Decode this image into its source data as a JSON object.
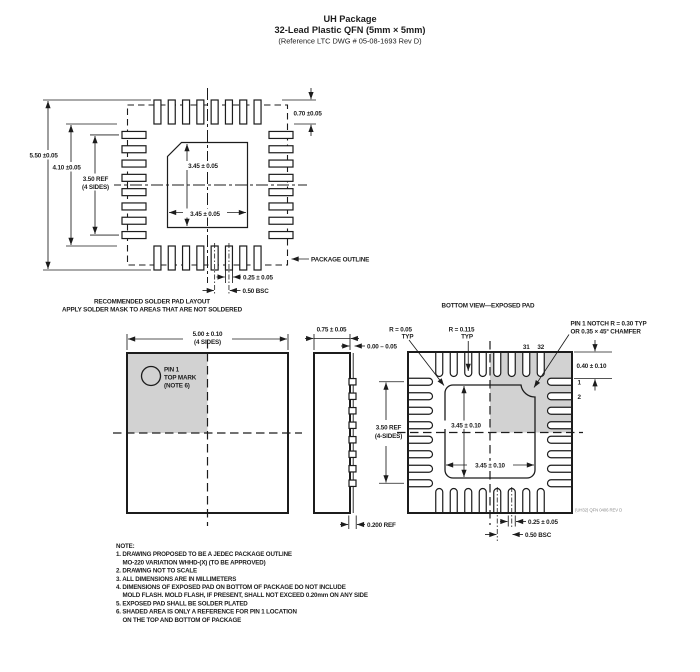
{
  "header": {
    "title": "UH Package",
    "subtitle": "32-Lead Plastic QFN (5mm × 5mm)",
    "reference": "(Reference LTC DWG # 05-08-1693 Rev D)"
  },
  "solder": {
    "caption1": "RECOMMENDED SOLDER PAD LAYOUT",
    "caption2": "APPLY SOLDER MASK TO AREAS THAT ARE NOT SOLDERED",
    "dim_overall": "5.50 ±0.05",
    "dim_inner": "4.10 ±0.05",
    "dim_span1": "3.50 REF",
    "dim_span2": "(4 SIDES)",
    "dim_pad_v": "3.45 ± 0.05",
    "dim_pad_h": "3.45 ± 0.05",
    "dim_pad_len": "0.70 ±0.05",
    "dim_pad_w": "0.25 ± 0.05",
    "dim_pitch": "0.50 BSC",
    "outline_label": "PACKAGE OUTLINE"
  },
  "top_view": {
    "dim1": "5.00 ± 0.10",
    "dim2": "(4 SIDES)",
    "pin1_l1": "PIN 1",
    "pin1_l2": "TOP MARK",
    "pin1_l3": "(NOTE 6)"
  },
  "side_view": {
    "dim_width": "0.75 ± 0.05",
    "dim_standoff": "0.00 – 0.05",
    "dim_lead": "0.200 REF"
  },
  "bottom_view": {
    "title": "BOTTOM VIEW—EXPOSED PAD",
    "span1": "3.50 REF",
    "span2": "(4-SIDES)",
    "r_pad1": "R = 0.05",
    "r_pad2": "TYP",
    "r_slot1": "R = 0.115",
    "r_slot2": "TYP",
    "notch1": "PIN 1 NOTCH R = 0.30 TYP",
    "notch2": "OR 0.35 × 45° CHAMFER",
    "dim_pad_v": "3.45 ± 0.10",
    "dim_pad_h": "3.45 ± 0.10",
    "dim_edge": "0.40 ± 0.10",
    "dim_lead_w": "0.25 ± 0.05",
    "dim_pitch": "0.50 BSC",
    "pin31": "31",
    "pin32": "32",
    "pin1": "1",
    "pin2": "2",
    "rev": "(UH32) QFN 0406 REV D"
  },
  "notes": {
    "heading": "NOTE:",
    "lines": [
      "1. DRAWING PROPOSED TO BE A JEDEC PACKAGE OUTLINE",
      "MO-220 VARIATION WHHD-(X) (TO BE APPROVED)",
      "2. DRAWING NOT TO SCALE",
      "3. ALL DIMENSIONS ARE IN MILLIMETERS",
      "4. DIMENSIONS OF EXPOSED PAD ON BOTTOM OF PACKAGE DO NOT INCLUDE",
      "MOLD FLASH. MOLD FLASH, IF PRESENT, SHALL NOT EXCEED 0.20mm ON ANY SIDE",
      "5. EXPOSED PAD SHALL BE SOLDER PLATED",
      "6. SHADED AREA IS ONLY A REFERENCE FOR PIN 1 LOCATION",
      "ON THE TOP AND BOTTOM OF PACKAGE"
    ]
  }
}
